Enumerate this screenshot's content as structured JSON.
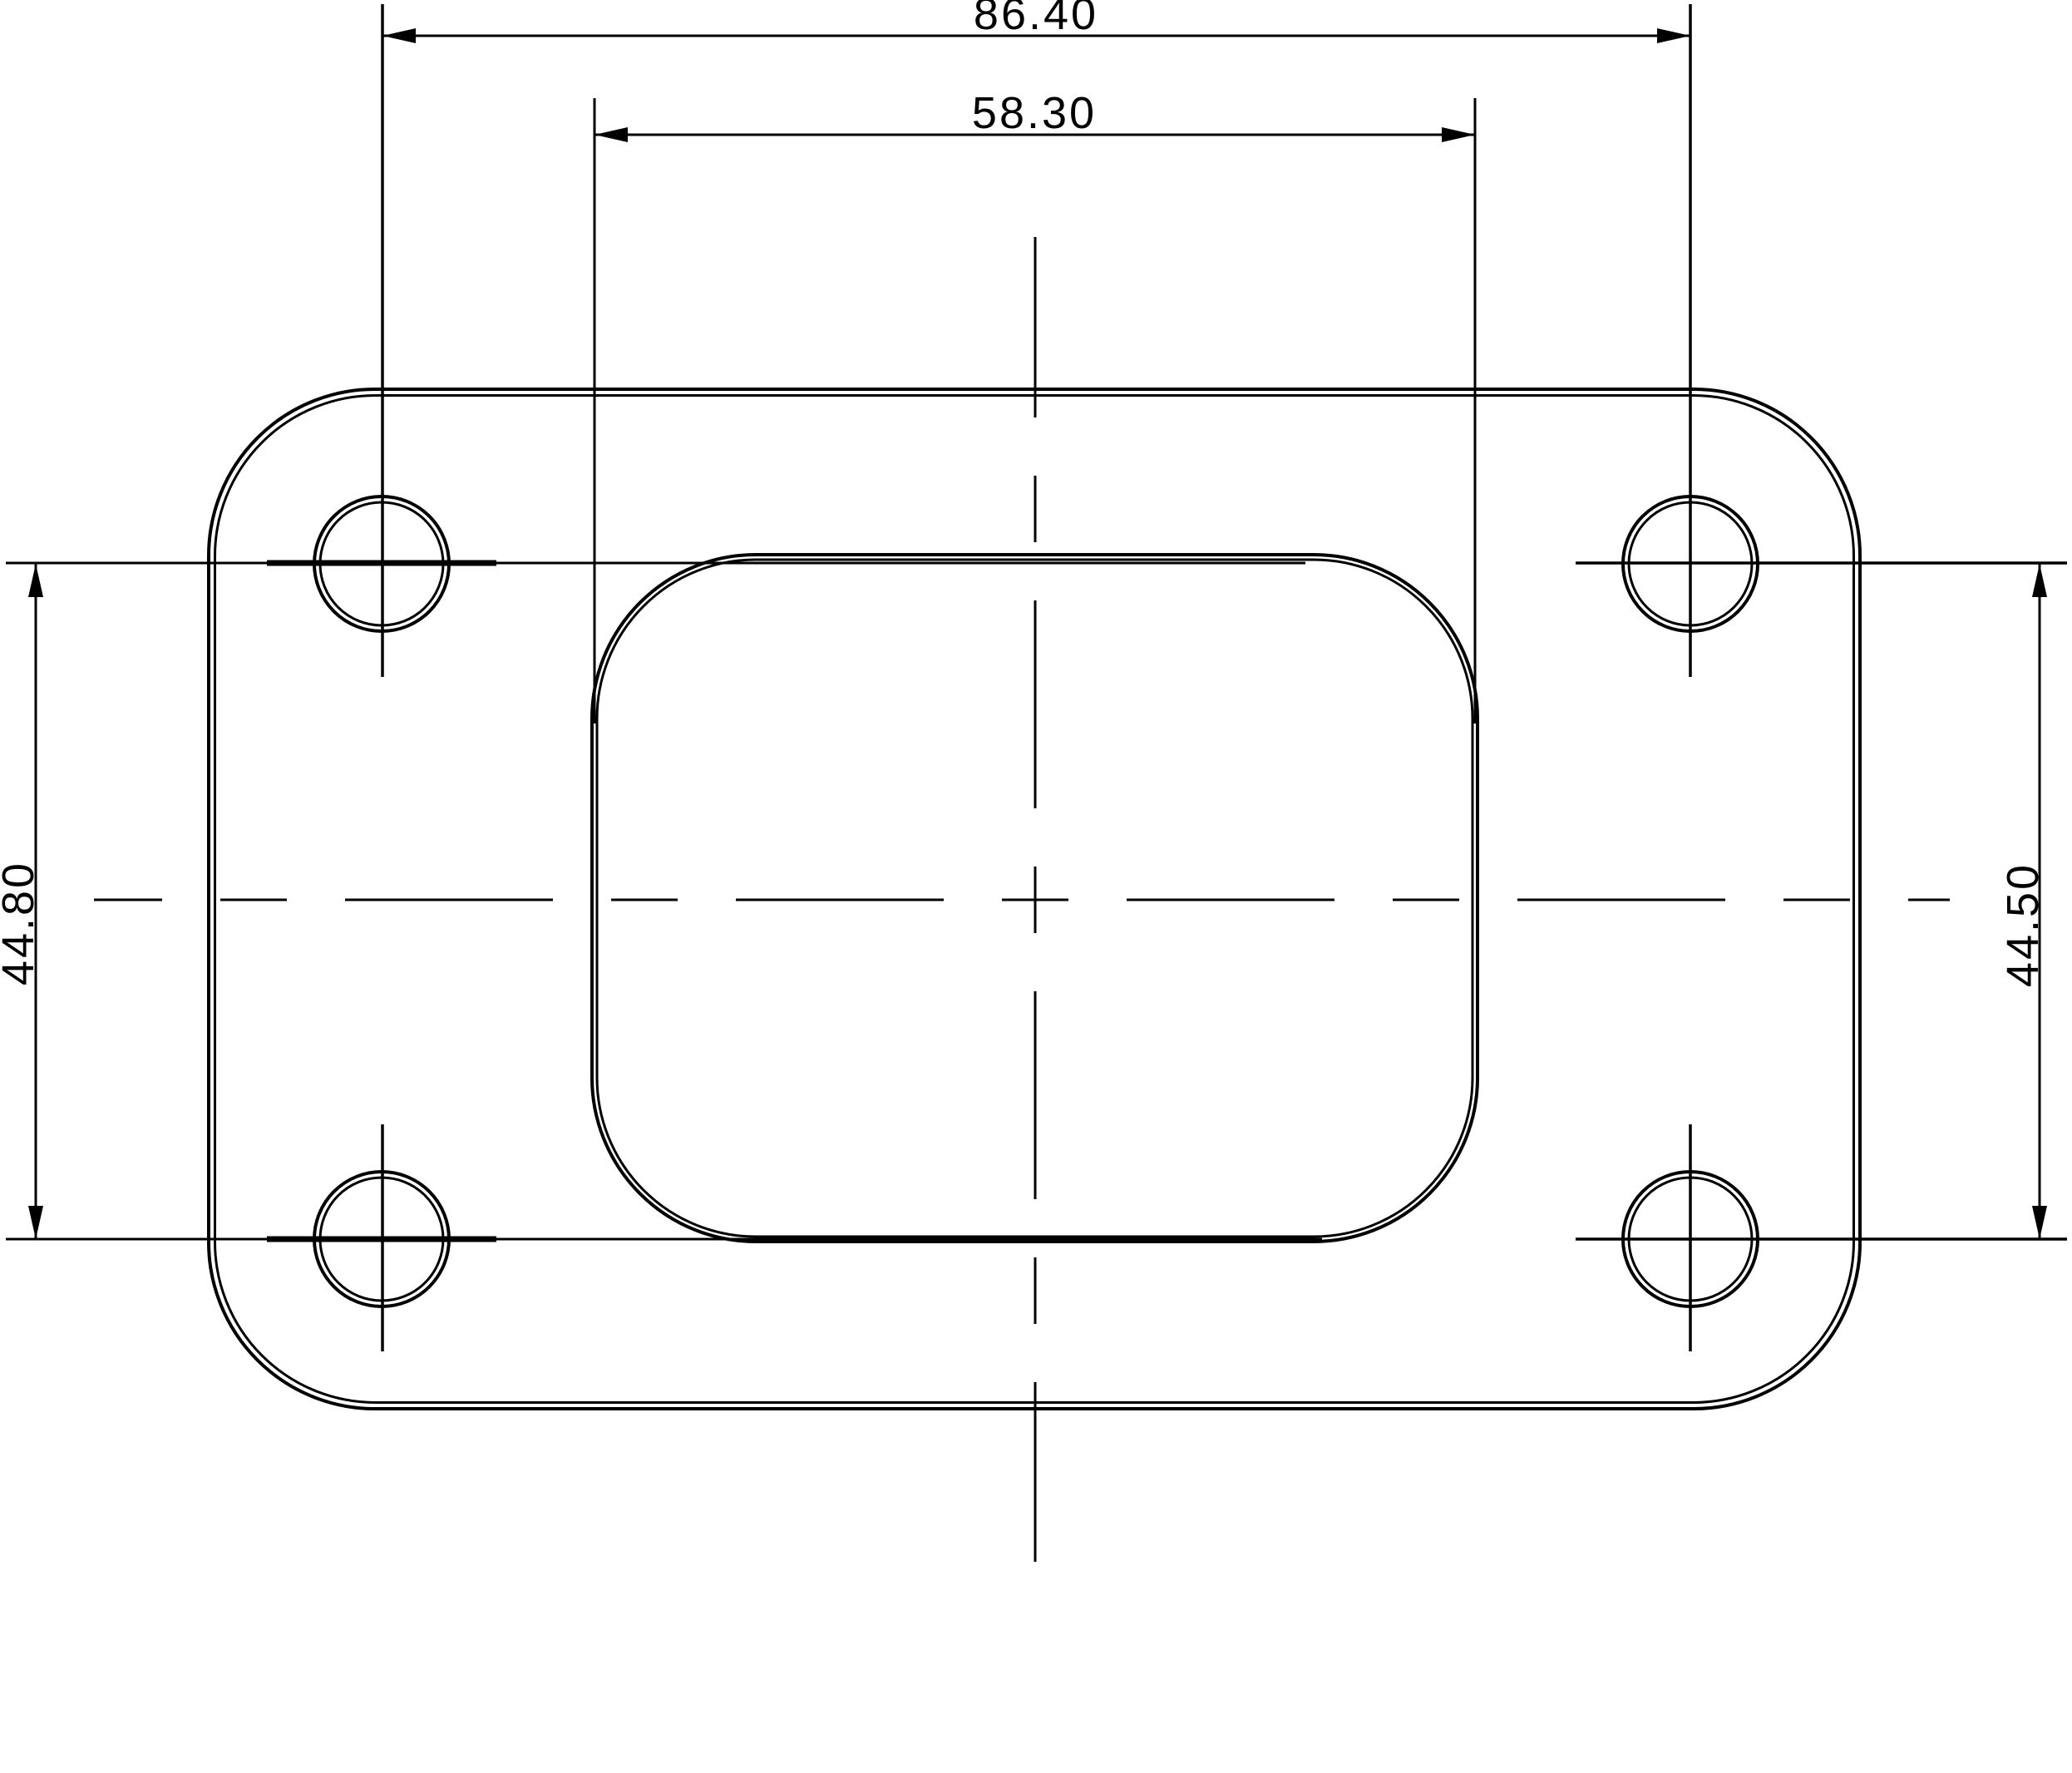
{
  "page": {
    "background": "#ffffff",
    "stroke_color": "#000000"
  },
  "drawing": {
    "type": "engineering-drawing",
    "view": "flange-gasket-front-view",
    "dimensions": {
      "bolt_span_width": {
        "label": "86.40",
        "value": 86.4,
        "orientation": "horizontal"
      },
      "opening_width": {
        "label": "58.30",
        "value": 58.3,
        "orientation": "horizontal"
      },
      "bolt_span_left": {
        "label": "44.80",
        "value": 44.8,
        "orientation": "vertical"
      },
      "bolt_span_right": {
        "label": "44.50",
        "value": 44.5,
        "orientation": "vertical"
      }
    }
  }
}
